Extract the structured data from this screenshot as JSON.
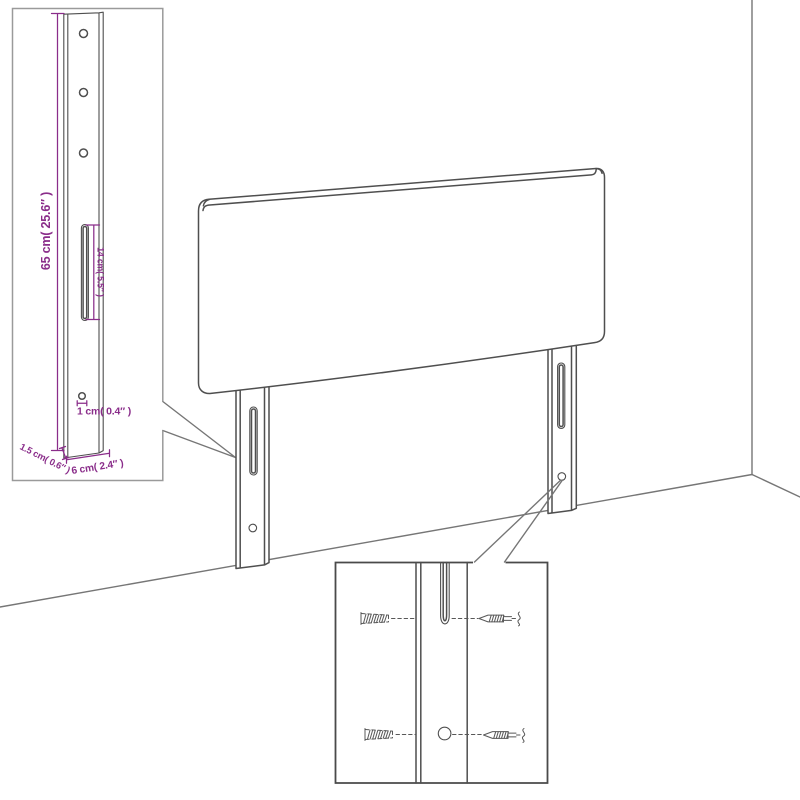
{
  "colors": {
    "accent": "#8a2d8a",
    "line": "#4f4f4f",
    "wall": "#767676",
    "inset1_border": "#9a9a9a",
    "inset2_border": "#4a4a4a",
    "background": "#ffffff"
  },
  "dimensions": {
    "height": "65 cm( 25.6″ )",
    "slot_length": "14 cm( 5.5″ )",
    "hole_diameter": "1 cm( 0.4″ )",
    "side_depth": "1.5 cm( 0.6″ )",
    "leg_width": "6 cm( 2.4″ )"
  },
  "icons": {
    "wall_plug": "wall-plug-icon",
    "screw": "screw-icon"
  }
}
